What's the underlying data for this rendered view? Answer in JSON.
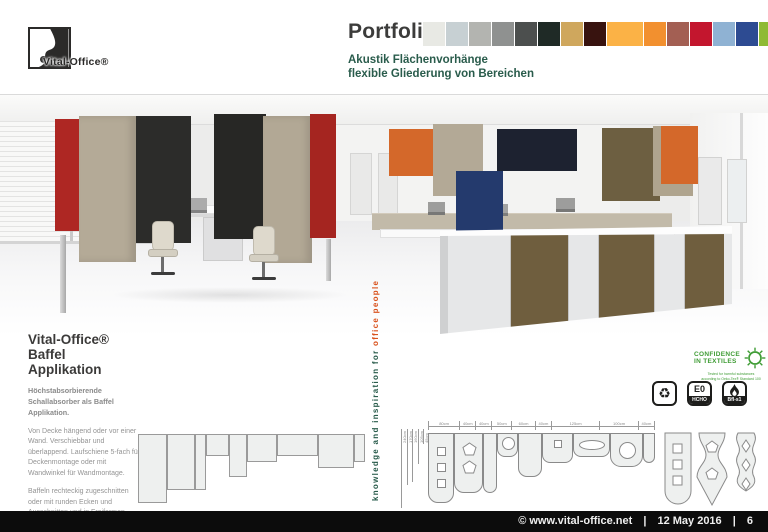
{
  "brand": {
    "name": "Vital-Office®"
  },
  "header": {
    "title": "Portfolio",
    "subtitle_line1": "Akustik Flächenvorhänge",
    "subtitle_line2": "flexible Gliederung von Bereichen",
    "swatches": [
      "#e8e9e4",
      "#c7d0d3",
      "#b3b4b0",
      "#8f9190",
      "#4c4f4e",
      "#1f2a26",
      "#cfa75d",
      "#38130f",
      "#fbb246",
      "#f2902f",
      "#a35f53",
      "#c3162e",
      "#8fb2d3",
      "#2d4b92",
      "#8fba34"
    ]
  },
  "info": {
    "heading_line1": "Vital-Office®",
    "heading_line2": "Baffel Applikation",
    "lead": "Höchstabsorbierende Schallabsorber als Baffel Applikation.",
    "para1": "Von Decke hängend oder vor einer Wand. Verschiebbar und überlappend. Laufschiene 5-fach für Deckenmontage oder mit Wandwinkel für Wandmontage.",
    "para2": "Baffeln rechteckig zugeschnitten oder mit runden Ecken und Ausschnitten und in Freiformen. Maximales Maß 2400x3200mm."
  },
  "banner": {
    "text_main": "knowledge and inspiration for ",
    "text_accent": "office people",
    "swatches": [
      "#d9a817",
      "#c5192b",
      "#2f9e3f",
      "#1e63a4",
      "linear-gradient(160deg,#f7f7f7 0%,#cccccc 45%,#8f8f8f 100%)"
    ]
  },
  "drawing": {
    "width_labels": [
      "80cm",
      "40cm",
      "40cm",
      "50cm",
      "60cm",
      "40cm",
      "125cm",
      "100cm",
      "40cm"
    ],
    "height_labels": [
      "240cm",
      "170cm",
      "160cm",
      "105cm",
      "45cm"
    ]
  },
  "certs": {
    "oeko_title_line1": "CONFIDENCE",
    "oeko_title_line2": "IN TEXTILES",
    "oeko_caption_line1": "Tested for harmful substances",
    "oeko_caption_line2": "according to Oeko-Tex® Standard 100",
    "badge_e0": "E0",
    "badge_hcho": "HCHO",
    "badge_fire": "Bfl-s1"
  },
  "footer": {
    "copyright": "© www.vital-office.net",
    "date": "12 May 2016",
    "page": "6",
    "separator": "|"
  },
  "palette": {
    "teal_text": "#2a5c4c",
    "accent_orange": "#d9531e",
    "heading_dark": "#3b3a39",
    "body_gray": "#949494",
    "baffle_red": "#ae2723",
    "baffle_taupe": "#b4aa97",
    "baffle_black": "#2c2c2a",
    "baffle_orange": "#d4682a",
    "baffle_navy": "#243a6d",
    "baffle_dark_navy": "#1d2230",
    "baffle_olive": "#6d5f41",
    "cabinet_brown": "#6f5e3e"
  }
}
